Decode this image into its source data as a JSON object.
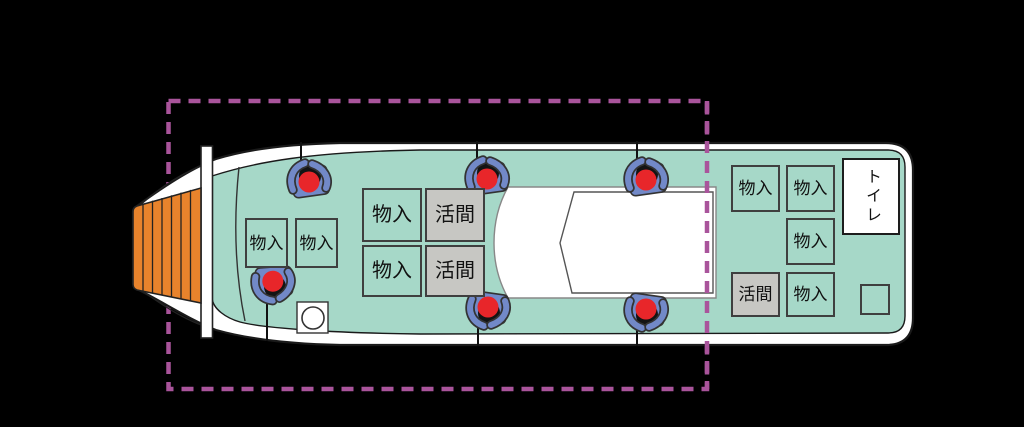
{
  "diagram": {
    "type": "fishing-boat deck plan (top view)",
    "labels": {
      "storage": "物入",
      "livewell": "活間",
      "toilet": "トイレ"
    },
    "boxes": [
      {
        "area": "bow",
        "type": "storage",
        "label": "物入"
      },
      {
        "area": "bow",
        "type": "storage",
        "label": "物入"
      },
      {
        "area": "midship",
        "type": "storage",
        "label": "物入"
      },
      {
        "area": "midship",
        "type": "livewell",
        "label": "活間"
      },
      {
        "area": "midship",
        "type": "storage",
        "label": "物入"
      },
      {
        "area": "midship",
        "type": "livewell",
        "label": "活間"
      },
      {
        "area": "stern",
        "type": "storage",
        "label": "物入"
      },
      {
        "area": "stern",
        "type": "storage",
        "label": "物入"
      },
      {
        "area": "stern",
        "type": "storage",
        "label": "物入"
      },
      {
        "area": "stern",
        "type": "livewell",
        "label": "活間"
      },
      {
        "area": "stern",
        "type": "storage",
        "label": "物入"
      },
      {
        "area": "stern",
        "type": "unlabeled",
        "label": ""
      },
      {
        "area": "stern",
        "type": "toilet",
        "label": "トイレ"
      }
    ],
    "icons": [
      {
        "name": "angler-icon",
        "count": 6
      },
      {
        "name": "fishing-rod-icon",
        "count": 6
      },
      {
        "name": "bait-bucket-icon",
        "count": 1
      }
    ],
    "highlight_region": {
      "style": "dashed rectangle",
      "color": "#a9549b"
    }
  },
  "colors": {
    "background": "#000000",
    "deck_teal": "#a6d8c8",
    "hull_white": "#ffffff",
    "bow_orange": "#e8832c",
    "box_gray": "#c7c7c3",
    "box_border": "#3f3f3f",
    "highlight_dashed": "#a9549b",
    "angler_blue": "#7289c8",
    "angler_red": "#e8262a"
  }
}
